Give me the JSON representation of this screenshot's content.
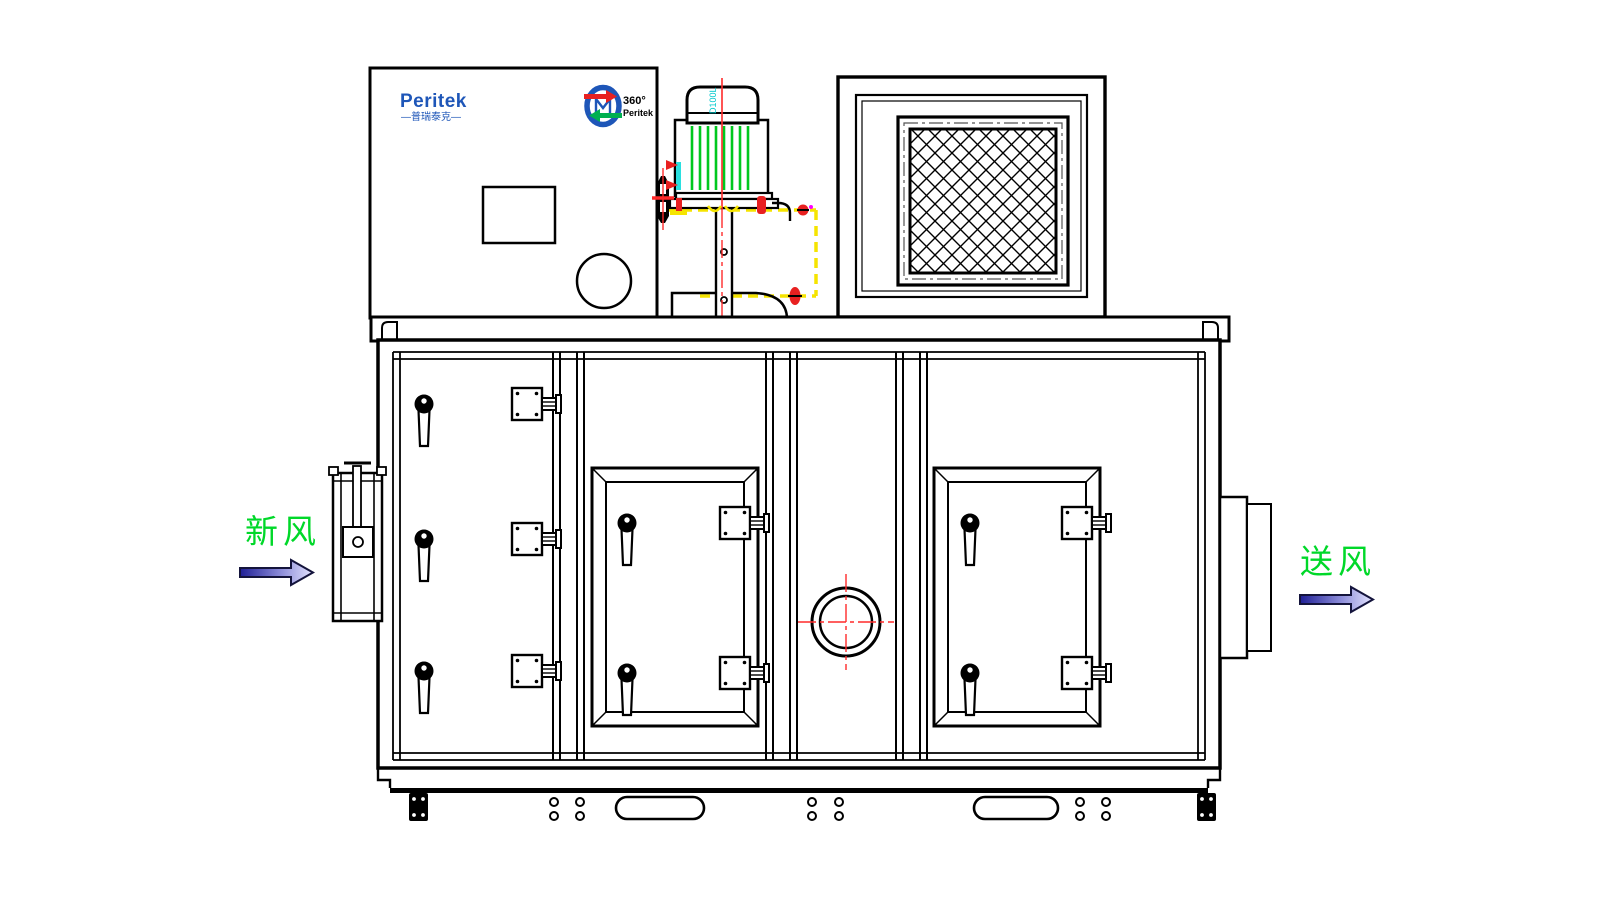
{
  "drawing": {
    "type": "front-view CAD drawing of a Peritek rotary dehumidifier / air handling unit",
    "flow_labels": {
      "fresh_air": "新风",
      "supply_air": "送风"
    },
    "branding": {
      "logo_text": "Peritek",
      "logo_subtext_cn": "—普瑞泰克—",
      "rotor_logo_degrees": "360°",
      "rotor_logo_brand": "Peritek"
    },
    "motor": {
      "model_label": "D100L"
    },
    "colors": {
      "line_black": "#000000",
      "label_green": "#00d829",
      "logo_blue": "#1e56b8",
      "motor_fin_green": "#00c81e",
      "centerline_red": "#ff2a2a",
      "hidden_duct_yellow": "#f5e400",
      "model_text_cyan": "#00c8cc",
      "arrow_dark_blue": "#1f1f96",
      "arrow_light_blue": "#e4e4ff",
      "rotor_arrow_red": "#e82020",
      "rotor_arrow_green": "#00b050",
      "magenta_dot": "#ff00ff"
    }
  }
}
